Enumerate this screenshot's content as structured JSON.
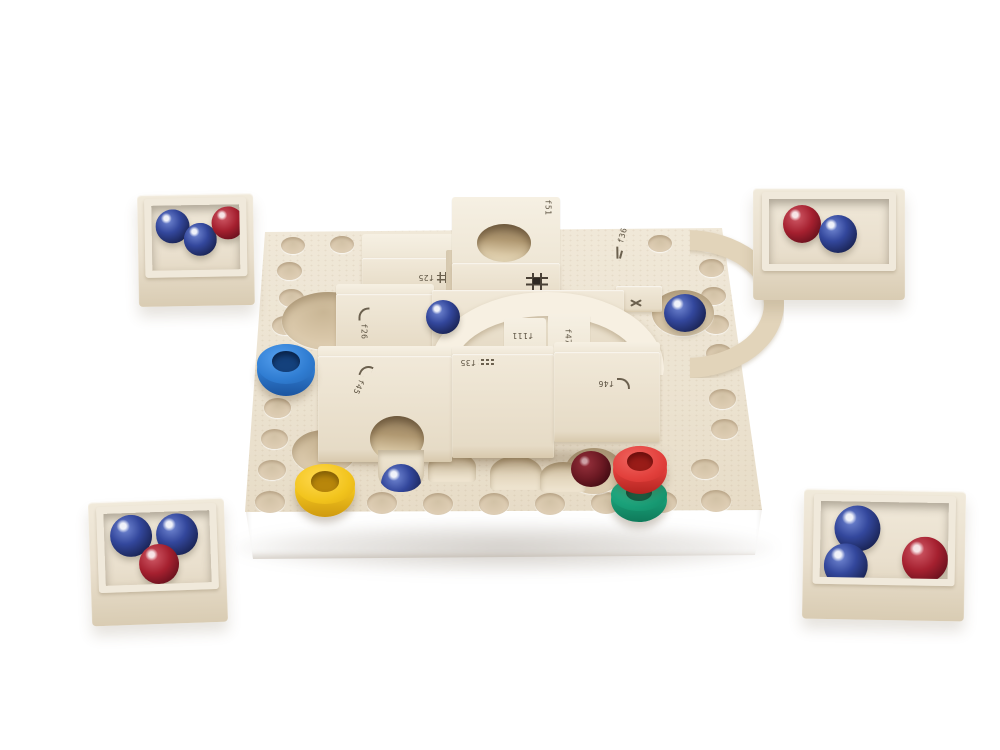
{
  "scene": {
    "description": "Wooden marble-run logic puzzle game: cream grid board with track blocks, marbles, colored rings and four corner marble trays, product photo on white",
    "background_color": "#ffffff"
  },
  "colors": {
    "wood_cream": "#ece3d2",
    "wood_shadow": "#d5c5aa",
    "block_face": "#f0e9da",
    "marble_blue": "#2c3f8f",
    "marble_red": "#a5202f",
    "marble_dark_red": "#6e1a24",
    "ring_blue": "#2f7cd1",
    "ring_yellow": "#f2c41d",
    "ring_red": "#e2403c",
    "ring_green": "#189d76"
  },
  "board": {
    "blocks": [
      {
        "label": "f51",
        "icon": "grid-cross-icon"
      },
      {
        "label": "f25",
        "icon": "grid-cross-icon"
      },
      {
        "label": "f26",
        "icon": "curve-icon"
      },
      {
        "label": "f35",
        "icon": "straight-track-icon"
      },
      {
        "label": "f111"
      },
      {
        "label": "f47"
      },
      {
        "label": "f45",
        "icon": "curve-icon"
      },
      {
        "label": "f46",
        "icon": "curve-icon"
      },
      {
        "label": "f36",
        "icon": "slope-icon"
      },
      {
        "icon": "crossing-curves-icon"
      }
    ],
    "rings": [
      "blue",
      "yellow",
      "red",
      "green"
    ],
    "marbles_on_board": [
      "blue",
      "blue",
      "blue",
      "darkred"
    ]
  },
  "trays": [
    {
      "position": "top-left",
      "marbles": [
        "blue",
        "blue",
        "red"
      ]
    },
    {
      "position": "top-right",
      "marbles": [
        "red",
        "blue"
      ]
    },
    {
      "position": "bottom-left",
      "marbles": [
        "blue",
        "blue",
        "red"
      ]
    },
    {
      "position": "bottom-right",
      "marbles": [
        "blue",
        "blue",
        "red"
      ]
    }
  ]
}
